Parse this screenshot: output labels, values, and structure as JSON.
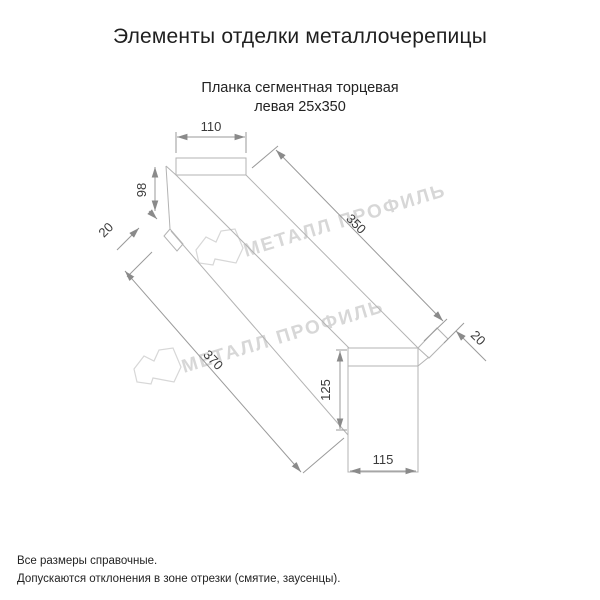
{
  "page": {
    "title": "Элементы отделки металлочерепицы"
  },
  "product": {
    "name_line1": "Планка сегментная торцевая",
    "name_line2": "левая 25х350"
  },
  "drawing": {
    "type": "technical-drawing",
    "dims": {
      "top_width": "110",
      "left_height": "98",
      "left_hem": "20",
      "top_length": "350",
      "right_hem": "20",
      "end_height": "125",
      "end_width": "115",
      "bottom_length": "370"
    }
  },
  "watermark": {
    "text": "МЕТАЛЛ ПРОФИЛЬ",
    "logo": "metall-profil-crown-logo"
  },
  "footer": {
    "note1": "Все размеры справочные.",
    "note2": "Допускаются отклонения в зоне отрезки (смятие, заусенцы)."
  },
  "colors": {
    "background": "#ffffff",
    "outline": "#b3b3b3",
    "dimension_text": "#3a3a3a",
    "watermark": "#d7d7d7",
    "text": "#1f1f1f"
  }
}
